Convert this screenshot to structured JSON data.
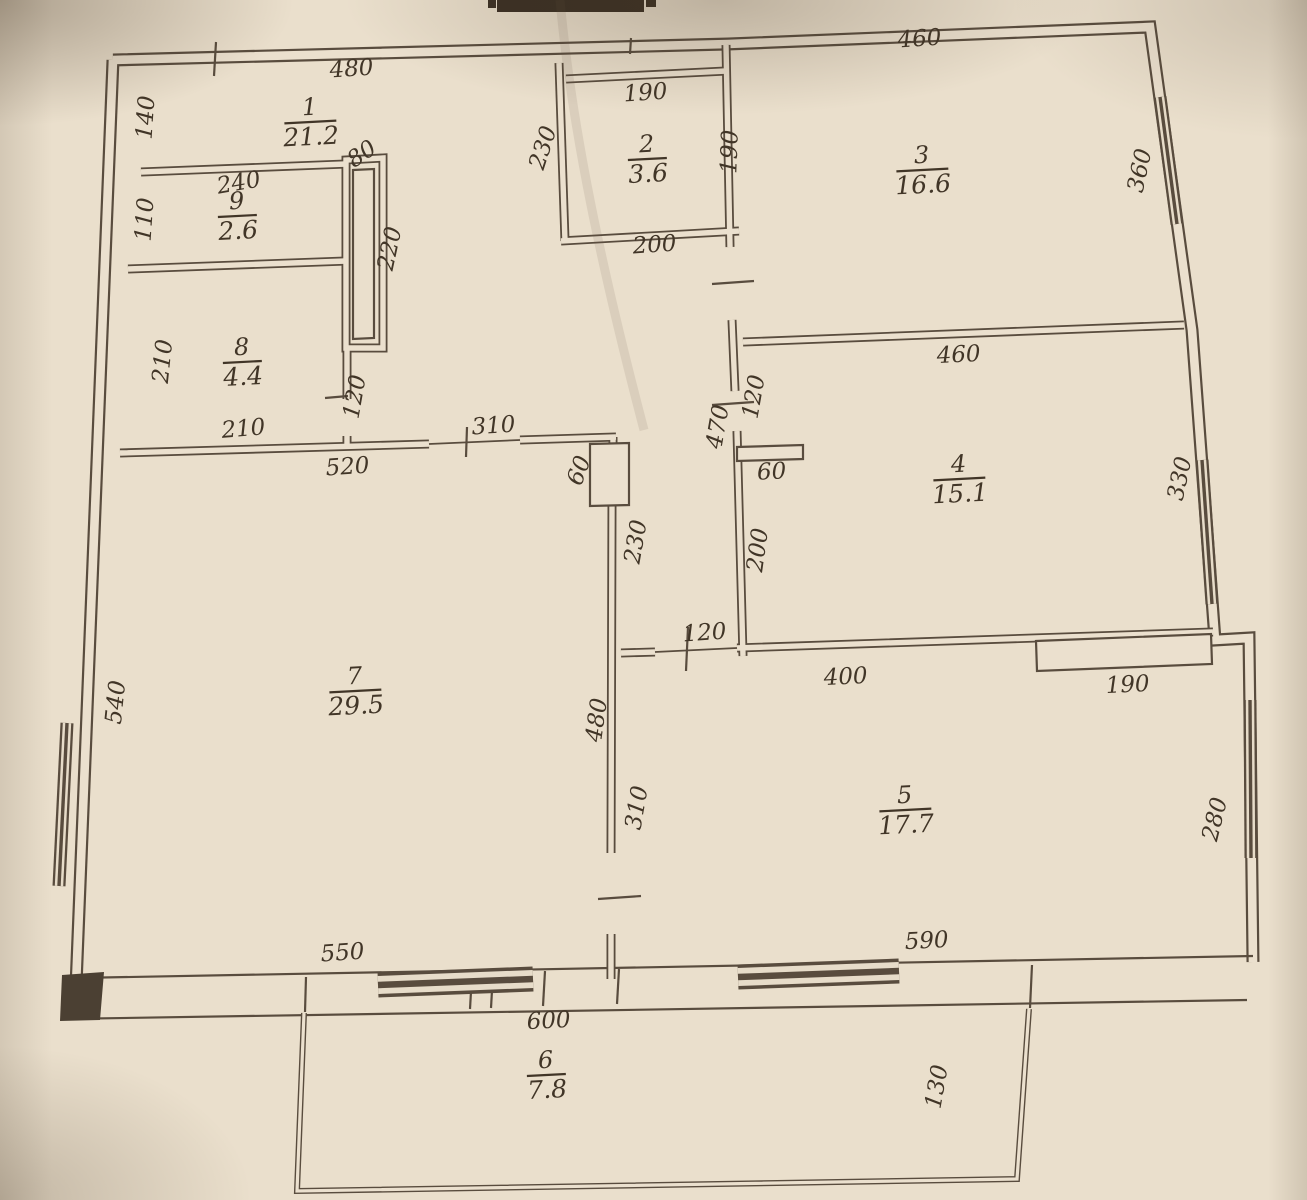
{
  "document": {
    "kind": "scanned floor plan",
    "palette": {
      "paper": "#eadfcc",
      "ink": "#4a3d2f",
      "text": "#413527"
    }
  },
  "rooms": [
    {
      "number": "1",
      "area": "21.2",
      "x": 310,
      "y": 115
    },
    {
      "number": "2",
      "area": "3.6",
      "x": 647,
      "y": 152
    },
    {
      "number": "3",
      "area": "16.6",
      "x": 922,
      "y": 163
    },
    {
      "number": "4",
      "area": "15.1",
      "x": 959,
      "y": 472
    },
    {
      "number": "5",
      "area": "17.7",
      "x": 905,
      "y": 803
    },
    {
      "number": "6",
      "area": "7.8",
      "x": 546,
      "y": 1068
    },
    {
      "number": "7",
      "area": "29.5",
      "x": 355,
      "y": 684
    },
    {
      "number": "8",
      "area": "4.4",
      "x": 242,
      "y": 355
    },
    {
      "number": "9",
      "area": "2.6",
      "x": 237,
      "y": 209
    }
  ],
  "dimensions": [
    {
      "text": "480",
      "x": 352,
      "y": 76,
      "rot": -4
    },
    {
      "text": "140",
      "x": 153,
      "y": 118,
      "rot": -86
    },
    {
      "text": "240",
      "x": 240,
      "y": 190,
      "rot": -10
    },
    {
      "text": "110",
      "x": 152,
      "y": 220,
      "rot": -86
    },
    {
      "text": "80",
      "x": 366,
      "y": 160,
      "rot": -35
    },
    {
      "text": "190",
      "x": 646,
      "y": 100,
      "rot": -4
    },
    {
      "text": "230",
      "x": 550,
      "y": 150,
      "rot": -72
    },
    {
      "text": "190",
      "x": 737,
      "y": 152,
      "rot": -88
    },
    {
      "text": "200",
      "x": 655,
      "y": 252,
      "rot": -4
    },
    {
      "text": "460",
      "x": 920,
      "y": 46,
      "rot": -4
    },
    {
      "text": "360",
      "x": 1147,
      "y": 172,
      "rot": -78
    },
    {
      "text": "220",
      "x": 397,
      "y": 250,
      "rot": -78
    },
    {
      "text": "210",
      "x": 170,
      "y": 362,
      "rot": -84
    },
    {
      "text": "210",
      "x": 244,
      "y": 436,
      "rot": -5
    },
    {
      "text": "120",
      "x": 362,
      "y": 398,
      "rot": -80
    },
    {
      "text": "520",
      "x": 348,
      "y": 474,
      "rot": -4
    },
    {
      "text": "310",
      "x": 494,
      "y": 433,
      "rot": -4
    },
    {
      "text": "60",
      "x": 586,
      "y": 473,
      "rot": -70
    },
    {
      "text": "230",
      "x": 643,
      "y": 543,
      "rot": -80
    },
    {
      "text": "470",
      "x": 725,
      "y": 428,
      "rot": -80
    },
    {
      "text": "120",
      "x": 761,
      "y": 398,
      "rot": -80
    },
    {
      "text": "60",
      "x": 772,
      "y": 479,
      "rot": -3
    },
    {
      "text": "200",
      "x": 765,
      "y": 551,
      "rot": -82
    },
    {
      "text": "460",
      "x": 959,
      "y": 362,
      "rot": -3
    },
    {
      "text": "330",
      "x": 1187,
      "y": 480,
      "rot": -78
    },
    {
      "text": "540",
      "x": 123,
      "y": 703,
      "rot": -84
    },
    {
      "text": "480",
      "x": 604,
      "y": 721,
      "rot": -82
    },
    {
      "text": "310",
      "x": 644,
      "y": 809,
      "rot": -80
    },
    {
      "text": "120",
      "x": 705,
      "y": 640,
      "rot": -4
    },
    {
      "text": "400",
      "x": 846,
      "y": 684,
      "rot": -3
    },
    {
      "text": "190",
      "x": 1128,
      "y": 692,
      "rot": -3
    },
    {
      "text": "280",
      "x": 1222,
      "y": 821,
      "rot": -76
    },
    {
      "text": "550",
      "x": 343,
      "y": 960,
      "rot": -4
    },
    {
      "text": "590",
      "x": 927,
      "y": 948,
      "rot": -3
    },
    {
      "text": "600",
      "x": 549,
      "y": 1028,
      "rot": -3
    },
    {
      "text": "130",
      "x": 944,
      "y": 1088,
      "rot": -80
    }
  ]
}
